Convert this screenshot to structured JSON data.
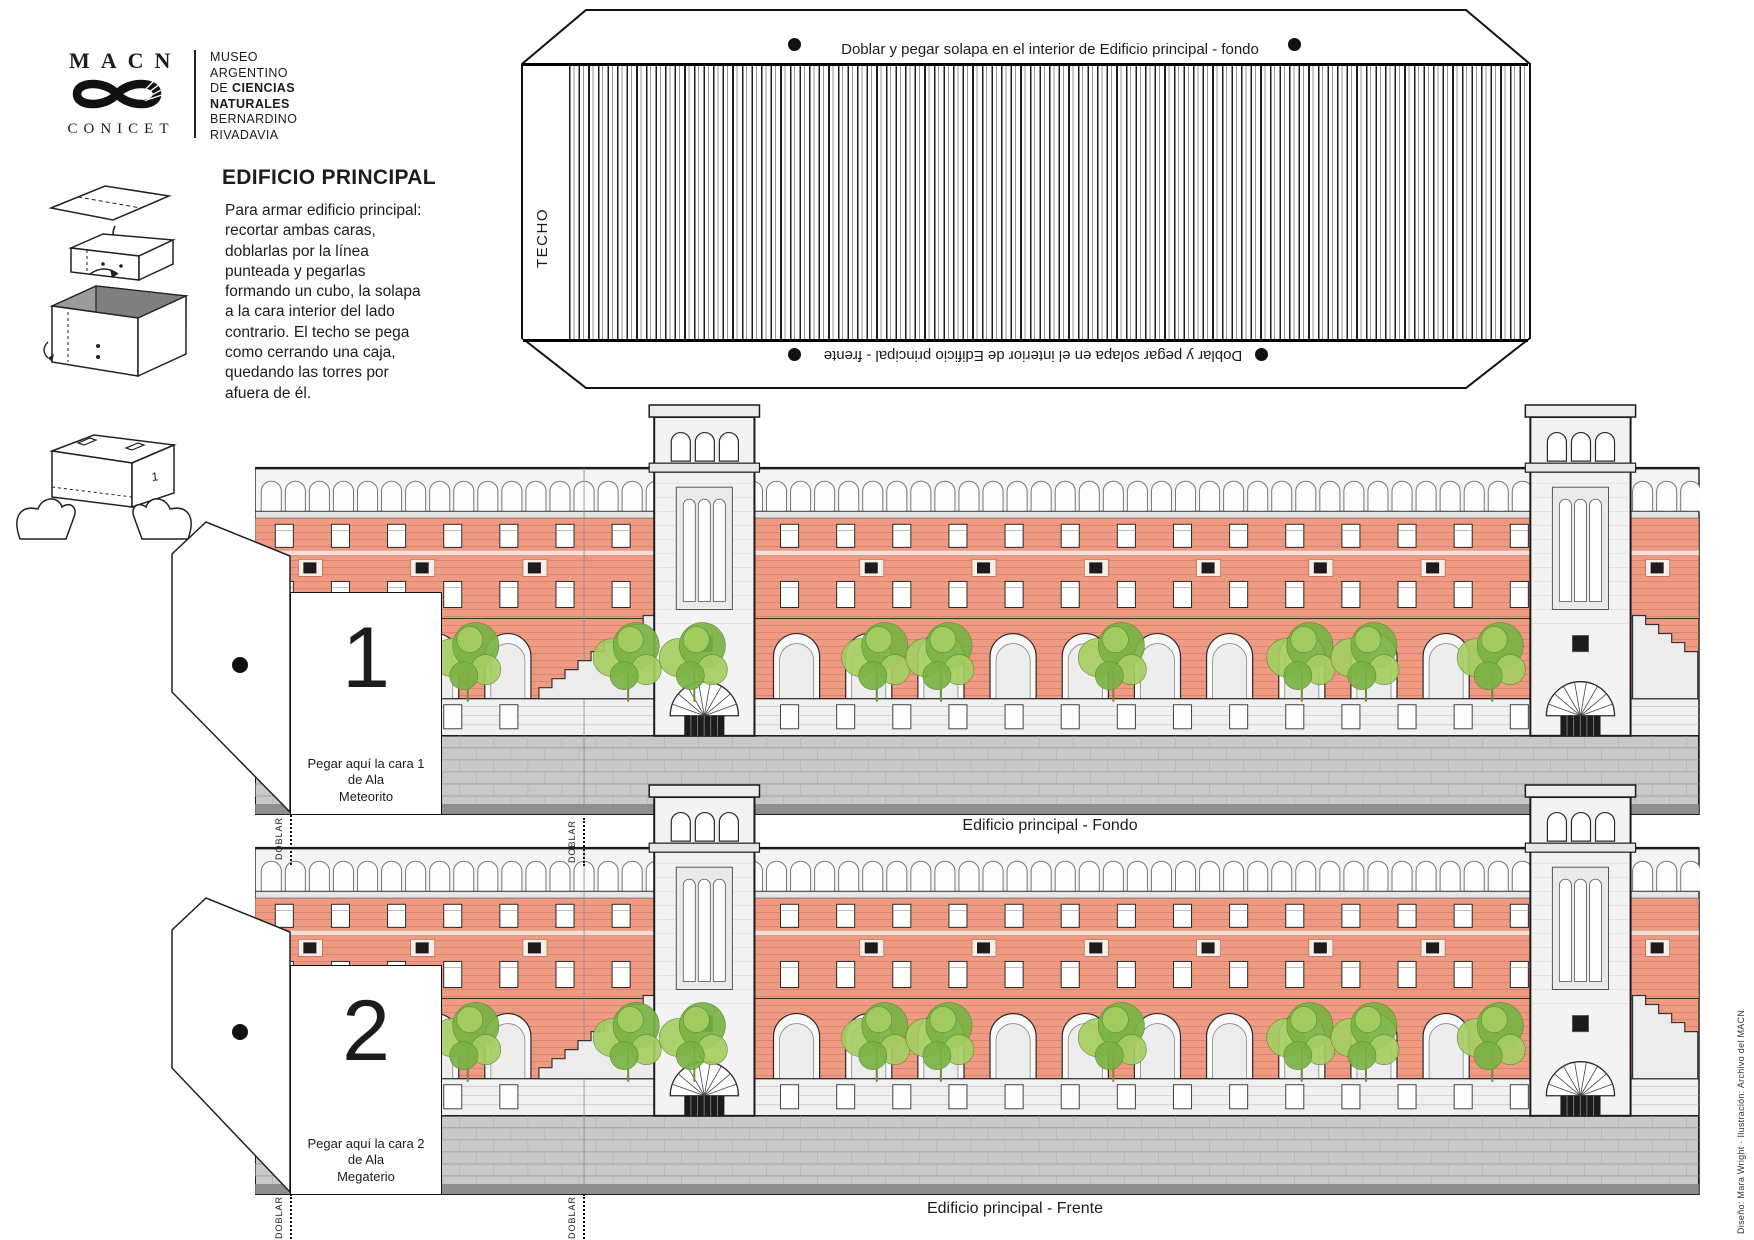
{
  "logo": {
    "acronym": "MACN",
    "conicet": "CONICET",
    "name_lines": [
      {
        "plain": "MUSEO",
        "bold": ""
      },
      {
        "plain": "ARGENTINO",
        "bold": ""
      },
      {
        "plain": "DE ",
        "bold": "CIENCIAS"
      },
      {
        "plain": "",
        "bold": "NATURALES"
      },
      {
        "plain": "BERNARDINO",
        "bold": ""
      },
      {
        "plain": "RIVADAVIA",
        "bold": ""
      }
    ]
  },
  "instructions": {
    "title": "EDIFICIO PRINCIPAL",
    "body": "Para armar edificio principal:\nrecortar ambas caras,\ndoblarlas por la línea\npunteada y pegarlas\nformando un cubo, la solapa\na la cara interior del lado\ncontrario. El techo se pega\ncomo cerrando una caja,\nquedando las torres por\nafuera de él."
  },
  "techo": {
    "label": "TECHO",
    "top_note": "Doblar y pegar solapa en el interior de Edificio principal - fondo",
    "bottom_note": "Doblar y pegar solapa en el interior de Edificio principal - frente"
  },
  "tabs": [
    {
      "number": "1",
      "note": "Pegar aquí la cara 1\nde Ala\nMeteorito"
    },
    {
      "number": "2",
      "note": "Pegar aquí la cara 2\nde Ala\nMegaterio"
    }
  ],
  "facades": [
    {
      "caption": "Edificio principal - Fondo"
    },
    {
      "caption": "Edificio principal - Frente"
    }
  ],
  "fold_label": "DOBLAR",
  "diagram_box_label": "1",
  "credit": "Diseño: Mara Wright · Ilustración: Archivo del MACN",
  "colors": {
    "brick": "#ef9a82",
    "brick_line": "#c96a55",
    "stone": "#f0f0f0",
    "base": "#c9c9c9",
    "base_dark": "#8e8e8e",
    "tree_light": "#a5cd62",
    "tree_dark": "#79b243",
    "ink": "#1c1c1c"
  }
}
